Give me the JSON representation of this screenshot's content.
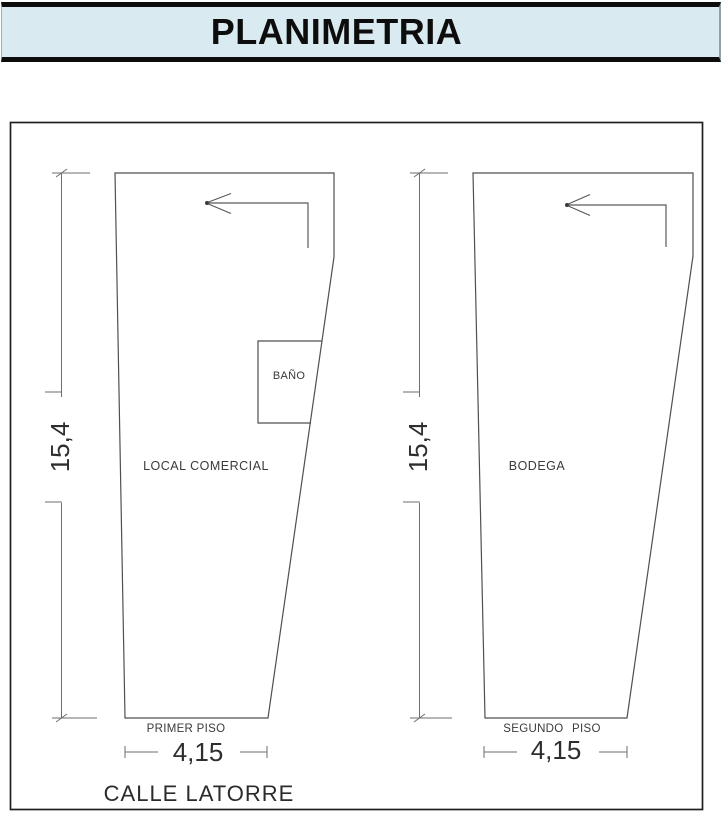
{
  "title": "PLANIMETRIA",
  "colors": {
    "title_background": "#d9eaf1",
    "title_text": "#0d0d0d",
    "drawing_lines": "#4f4f4f",
    "frame": "#202020",
    "label_text": "#3a3a3a"
  },
  "plans": {
    "first_floor": {
      "room_label": "LOCAL COMERCIAL",
      "bath_label": "BAÑO",
      "floor_label": "PRIMER PISO",
      "height_dim": "15,4",
      "width_dim": "4,15"
    },
    "second_floor": {
      "room_label": "BODEGA",
      "floor_label": "SEGUNDO PISO",
      "height_dim": "15,4",
      "width_dim": "4,15"
    }
  },
  "street_label": "CALLE LATORRE"
}
